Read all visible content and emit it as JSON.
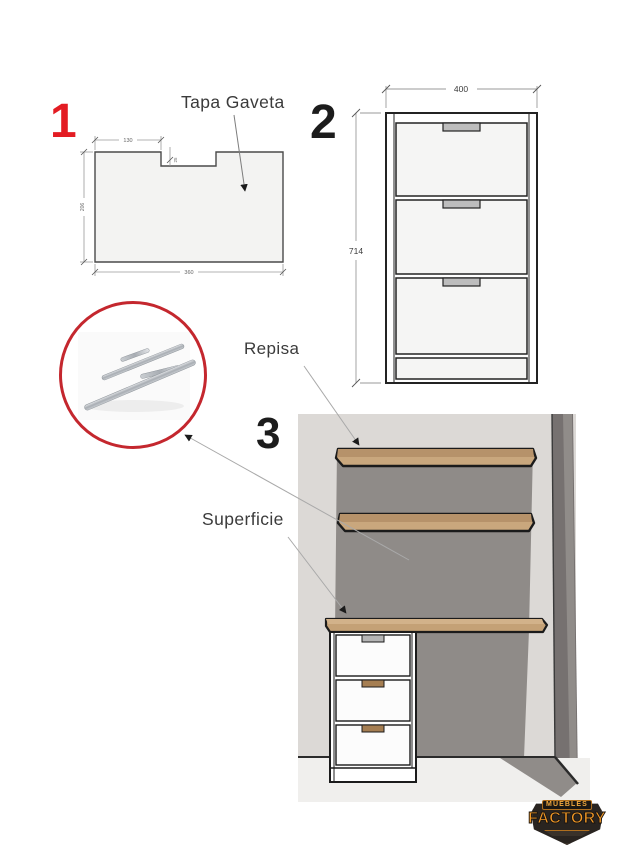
{
  "steps": [
    {
      "number": "1",
      "part_label": "Tapa Gaveta",
      "dimensions": {
        "top_notch_offset": "130",
        "notch_depth": "25",
        "height": "206",
        "width": "360"
      }
    },
    {
      "number": "2",
      "dimensions": {
        "width": "400",
        "height": "714"
      },
      "drawer_count": 3
    },
    {
      "number": "3",
      "labels": {
        "repisa": "Repisa",
        "superficie": "Superficie",
        "soporte_invisible": "Soporte\nInvisible"
      }
    }
  ],
  "logo": {
    "top": "MUEBLES",
    "bottom": "FACTORY"
  },
  "colors": {
    "accent_red": "#e31c23",
    "circle_red": "#c4272e",
    "ink": "#1c1c1c",
    "wood_top": "#b6926a",
    "wood_front": "#c9a77d",
    "wall_light": "#dcd9d6",
    "wall_shadow": "#8f8b88",
    "wall_corner": "#767170",
    "handle_gray": "#b5b5b5",
    "handle_wood": "#a57e52",
    "logo_orange": "#f59a26"
  }
}
